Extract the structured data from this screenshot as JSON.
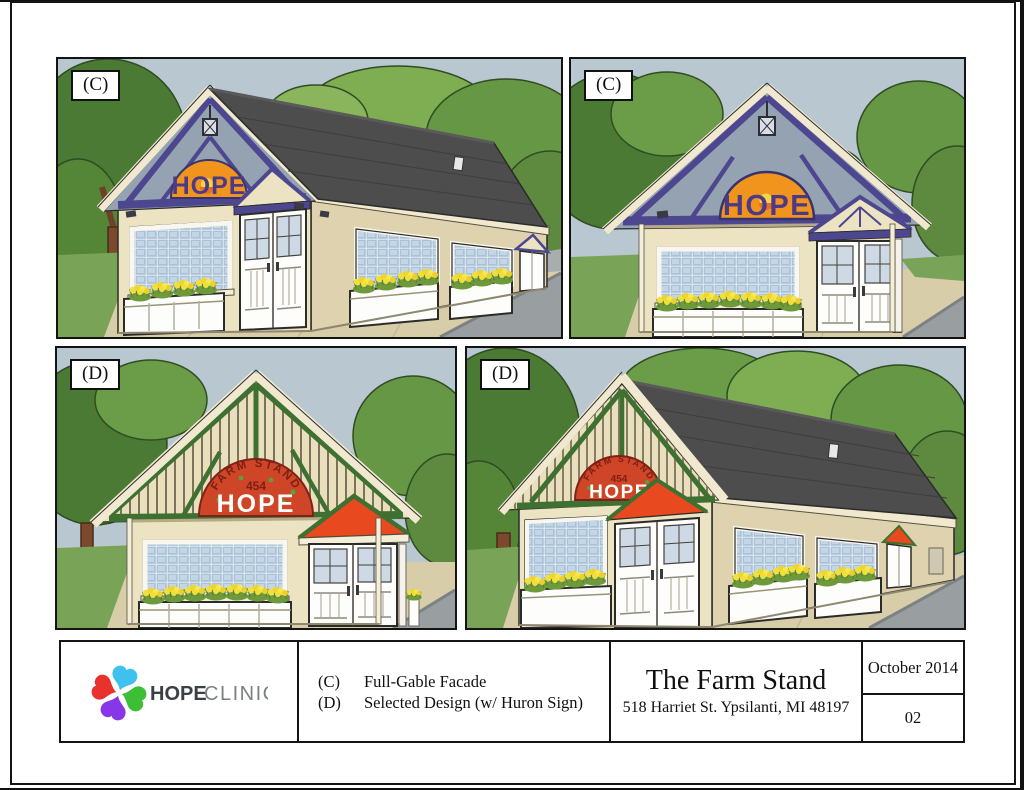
{
  "page": {
    "background": "#ffffff",
    "frame_color": "#141414"
  },
  "panels": [
    {
      "label": "(C)",
      "name": "full-gable-facade-perspective",
      "sign": {
        "text": "HOPE"
      }
    },
    {
      "label": "(C)",
      "name": "full-gable-facade-front",
      "sign": {
        "text": "HOPE"
      }
    },
    {
      "label": "(D)",
      "name": "selected-design-front",
      "sign": {
        "arc": "FARM STAND",
        "number": "454",
        "text": "HOPE"
      }
    },
    {
      "label": "(D)",
      "name": "selected-design-perspective",
      "sign": {
        "arc": "FARM STAND",
        "number": "454",
        "text": "HOPE"
      }
    }
  ],
  "title_block": {
    "logo": {
      "word1": "HOPE",
      "word2": "CLINIC"
    },
    "legend": [
      {
        "key": "(C)",
        "desc": "Full-Gable Facade"
      },
      {
        "key": "(D)",
        "desc": "Selected Design (w/ Huron Sign)"
      }
    ],
    "project_title": "The Farm Stand",
    "project_address": "518 Harriet St. Ypsilanti, MI 48197",
    "date": "October 2014",
    "sheet_number": "02"
  },
  "colors": {
    "sky": "#b9c7d1",
    "wall": "#ece3c2",
    "wall_shade": "#ded3ae",
    "roof": "#4d4d4d",
    "truss_purple": "#4c478e",
    "trim_green": "#3e7031",
    "sign_orange": "#f0941e",
    "sign_red": "#cf4527",
    "pediment_orange": "#e8491f",
    "glass": "#b9cddf",
    "flowers": "#f2e03a",
    "grass": "#79a457",
    "sidewalk": "#d8cda9",
    "road": "#999fa1",
    "tree_dark": "#4a7a33",
    "tree_mid": "#6b9c47"
  }
}
